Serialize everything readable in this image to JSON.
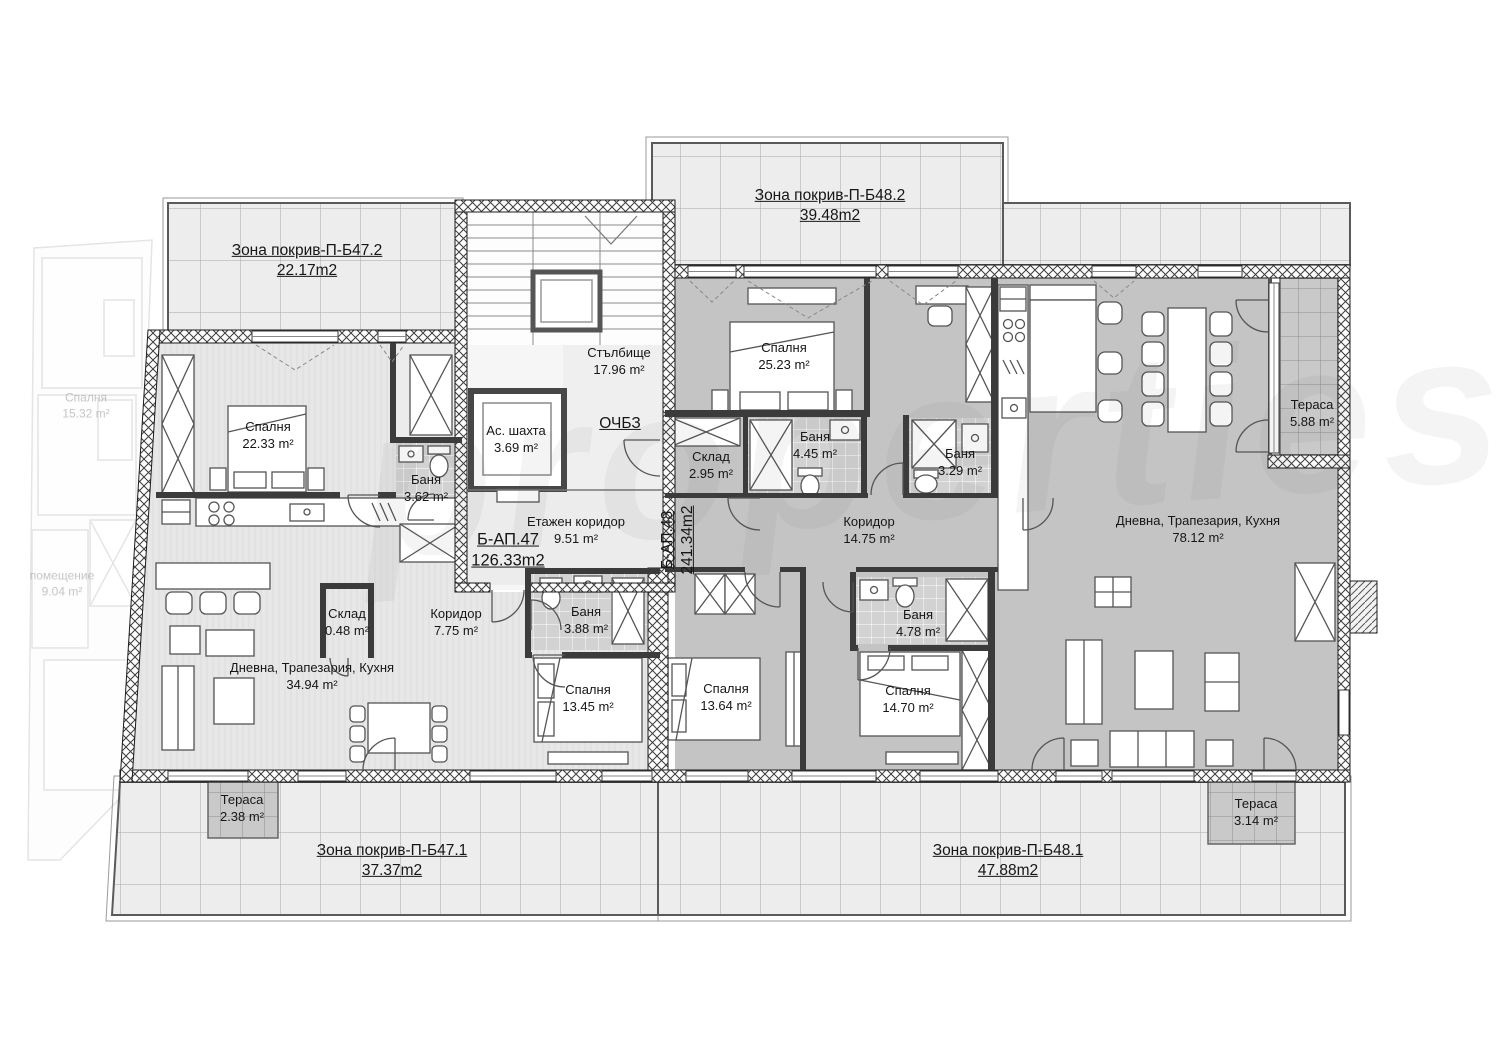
{
  "watermark_text": "properties",
  "plan": {
    "roof_zones": {
      "b472": {
        "name": "Зона покрив-П-Б47.2",
        "area": "22.17m2"
      },
      "b482": {
        "name": "Зона покрив-П-Б48.2",
        "area": "39.48m2"
      },
      "b471": {
        "name": "Зона покрив-П-Б47.1",
        "area": "37.37m2"
      },
      "b481": {
        "name": "Зона покрив-П-Б48.1",
        "area": "47.88m2"
      }
    },
    "common_areas": {
      "staircase": {
        "name": "Стълбище",
        "area": "17.96 m²"
      },
      "elevator_shaft": {
        "name": "Ас. шахта",
        "area": "3.69 m²"
      },
      "floor_corridor": {
        "name": "Етажен коридор",
        "area": "9.51 m²"
      },
      "och_bz": {
        "label": "ОЧБЗ"
      }
    },
    "apartment_47": {
      "id": "Б-АП.47",
      "total_area": "126.33m2",
      "bedroom_1": {
        "name": "Спалня",
        "area": "22.33 m²"
      },
      "bathroom_1": {
        "name": "Баня",
        "area": "3.62 m²"
      },
      "storage": {
        "name": "Склад",
        "area": "0.48 m²"
      },
      "corridor": {
        "name": "Коридор",
        "area": "7.75 m²"
      },
      "living": {
        "name": "Дневна, Трапезария, Кухня",
        "area": "34.94 m²"
      },
      "bathroom_2": {
        "name": "Баня",
        "area": "3.88 m²"
      },
      "bedroom_2": {
        "name": "Спалня",
        "area": "13.45 m²"
      },
      "terrace": {
        "name": "Тераса",
        "area": "2.38 m²"
      }
    },
    "apartment_48": {
      "id": "Б-АП.48",
      "total_area": "241.34m2",
      "bedroom_1": {
        "name": "Спалня",
        "area": "25.23 m²"
      },
      "storage": {
        "name": "Склад",
        "area": "2.95 m²"
      },
      "bathroom_1": {
        "name": "Баня",
        "area": "4.45 m²"
      },
      "bathroom_2": {
        "name": "Баня",
        "area": "3.29 m²"
      },
      "corridor": {
        "name": "Коридор",
        "area": "14.75 m²"
      },
      "bathroom_3": {
        "name": "Баня",
        "area": "4.78 m²"
      },
      "bedroom_2": {
        "name": "Спалня",
        "area": "13.64 m²"
      },
      "bedroom_3": {
        "name": "Спалня",
        "area": "14.70 m²"
      },
      "living": {
        "name": "Дневна, Трапезария, Кухня",
        "area": "78.12 m²"
      },
      "terrace_1": {
        "name": "Тераса",
        "area": "5.88 m²"
      },
      "terrace_2": {
        "name": "Тераса",
        "area": "3.14 m²"
      }
    },
    "adjacent_unit": {
      "bedroom": {
        "name": "Спалня",
        "area": "15.32 m²"
      },
      "room": {
        "name": "помещение",
        "area": "9.04 m²"
      }
    }
  }
}
